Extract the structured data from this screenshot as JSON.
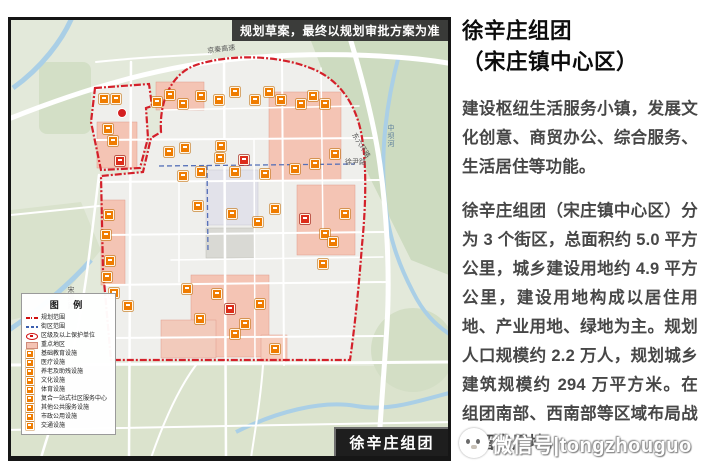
{
  "banner": {
    "text": "规划草案，最终以规划审批方案为准"
  },
  "map": {
    "corner_label": "徐辛庄组团",
    "legend": {
      "title": "图 例",
      "items": [
        {
          "type": "line-red",
          "label": "规划范围"
        },
        {
          "type": "line-blue",
          "label": "街区范围"
        },
        {
          "type": "oval-red",
          "label": "区级及以上保护单位"
        },
        {
          "type": "fill-pink",
          "label": "重点地区"
        },
        {
          "type": "icon",
          "label": "基础教育设施"
        },
        {
          "type": "icon",
          "label": "医疗设施"
        },
        {
          "type": "icon",
          "label": "养老及助残设施"
        },
        {
          "type": "icon",
          "label": "文化设施"
        },
        {
          "type": "icon",
          "label": "体育设施"
        },
        {
          "type": "icon",
          "label": "复合一站式社区服务中心"
        },
        {
          "type": "icon",
          "label": "其他公共服务设施"
        },
        {
          "type": "icon",
          "label": "市政公用设施"
        },
        {
          "type": "icon",
          "label": "交通设施"
        }
      ]
    },
    "road_labels": [
      {
        "text": "京秦高速",
        "x": 196,
        "y": 28,
        "rot": -7,
        "vertical": false,
        "color": "#5a5a5a"
      },
      {
        "text": "东六环路",
        "x": 345,
        "y": 112,
        "rot": 58,
        "vertical": false,
        "color": "#5a5a5a"
      },
      {
        "text": "中坝河",
        "x": 376,
        "y": 104,
        "rot": 0,
        "vertical": true,
        "color": "#5d7f9c"
      },
      {
        "text": "宋梁路",
        "x": 56,
        "y": 266,
        "rot": 0,
        "vertical": true,
        "color": "#5a5a5a"
      },
      {
        "text": "徐尹路",
        "x": 334,
        "y": 139,
        "rot": 0,
        "vertical": false,
        "color": "#5a5a5a"
      }
    ],
    "icons": [
      {
        "x": 88,
        "y": 74
      },
      {
        "x": 100,
        "y": 74
      },
      {
        "x": 92,
        "y": 104
      },
      {
        "x": 97,
        "y": 116
      },
      {
        "x": 104,
        "y": 136,
        "t": "r"
      },
      {
        "x": 93,
        "y": 190
      },
      {
        "x": 90,
        "y": 210
      },
      {
        "x": 94,
        "y": 236
      },
      {
        "x": 91,
        "y": 252
      },
      {
        "x": 98,
        "y": 268
      },
      {
        "x": 112,
        "y": 281
      },
      {
        "x": 141,
        "y": 77
      },
      {
        "x": 154,
        "y": 70
      },
      {
        "x": 167,
        "y": 79
      },
      {
        "x": 185,
        "y": 71
      },
      {
        "x": 203,
        "y": 75
      },
      {
        "x": 219,
        "y": 67
      },
      {
        "x": 239,
        "y": 75
      },
      {
        "x": 253,
        "y": 67
      },
      {
        "x": 265,
        "y": 75
      },
      {
        "x": 285,
        "y": 79
      },
      {
        "x": 297,
        "y": 71
      },
      {
        "x": 309,
        "y": 79
      },
      {
        "x": 153,
        "y": 127
      },
      {
        "x": 169,
        "y": 123
      },
      {
        "x": 205,
        "y": 121
      },
      {
        "x": 204,
        "y": 133
      },
      {
        "x": 228,
        "y": 135,
        "t": "r"
      },
      {
        "x": 167,
        "y": 151
      },
      {
        "x": 185,
        "y": 147
      },
      {
        "x": 219,
        "y": 147
      },
      {
        "x": 249,
        "y": 149
      },
      {
        "x": 279,
        "y": 144
      },
      {
        "x": 299,
        "y": 139
      },
      {
        "x": 319,
        "y": 129
      },
      {
        "x": 182,
        "y": 181
      },
      {
        "x": 216,
        "y": 189
      },
      {
        "x": 242,
        "y": 197
      },
      {
        "x": 259,
        "y": 184
      },
      {
        "x": 289,
        "y": 194,
        "t": "r"
      },
      {
        "x": 309,
        "y": 209
      },
      {
        "x": 329,
        "y": 189
      },
      {
        "x": 307,
        "y": 239
      },
      {
        "x": 317,
        "y": 217
      },
      {
        "x": 171,
        "y": 264
      },
      {
        "x": 184,
        "y": 294
      },
      {
        "x": 201,
        "y": 269
      },
      {
        "x": 214,
        "y": 284,
        "t": "r"
      },
      {
        "x": 229,
        "y": 299
      },
      {
        "x": 244,
        "y": 279
      },
      {
        "x": 219,
        "y": 309
      },
      {
        "x": 259,
        "y": 324
      }
    ]
  },
  "article": {
    "title_line1": "徐辛庄组团",
    "title_line2": "（宋庄镇中心区）",
    "paragraphs": [
      "建设枢纽生活服务小镇，发展文化创意、商贸办公、综合服务、生活居住等功能。",
      "徐辛庄组团（宋庄镇中心区）分为 3 个街区，总面积约 5.0 平方公里，城乡建设用地约 4.9 平方公里，建设用地构成以居住用地、产业用地、绿地为主。规划人口规模约 2.2 万人，规划城乡建筑规模约 294 万平方米。在组团南部、西南部等区域布局战略留白用地。"
    ]
  },
  "watermark": {
    "text": "微信号|tongzhouguo"
  }
}
